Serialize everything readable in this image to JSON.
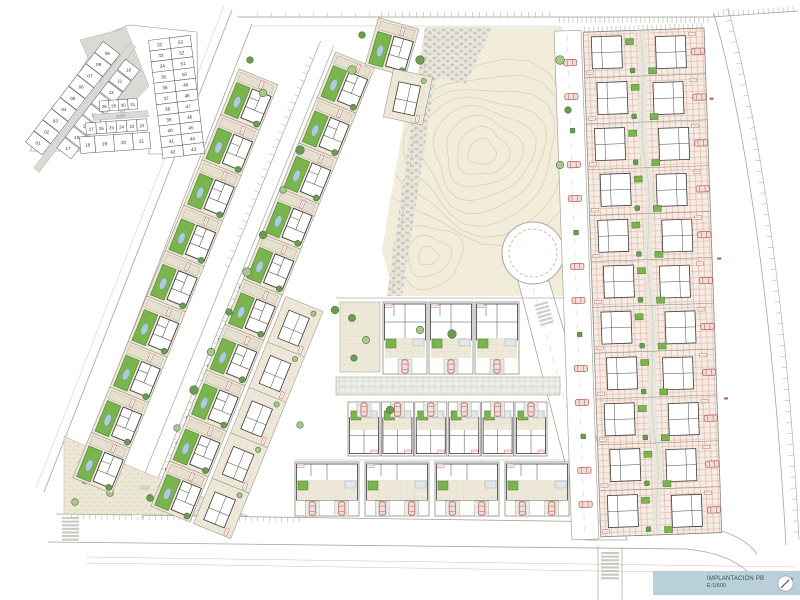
{
  "title_block": {
    "title": "IMPLANTACIÓN PB",
    "scale": "E:1/600",
    "north_label": "N"
  },
  "keyplan": {
    "zone_labels": [
      "ZC01",
      "ZC02"
    ],
    "strip_a": [
      "01",
      "02",
      "03",
      "04",
      "05",
      "06",
      "07",
      "08",
      "09"
    ],
    "strip_b": [
      "10",
      "11",
      "12",
      "13",
      "14",
      "15",
      "16",
      "17"
    ],
    "row_18_21": [
      "18",
      "19",
      "20",
      "21"
    ],
    "row_22_27": [
      "27",
      "26",
      "25",
      "24",
      "23",
      "22"
    ],
    "row_28_31": [
      "28",
      "29",
      "30",
      "31"
    ],
    "col_left": [
      "32",
      "33",
      "34",
      "35",
      "36",
      "37",
      "38",
      "39",
      "40",
      "41",
      "42"
    ],
    "col_right": [
      "53",
      "52",
      "51",
      "50",
      "49",
      "48",
      "47",
      "46",
      "45",
      "44",
      "43"
    ]
  },
  "plan_summary": {
    "villas_west_band": 9,
    "villas_east_band": 8,
    "townhouse_units": 14,
    "right_block_units": 22,
    "right_block_rows": 11,
    "right_block_cols": 2,
    "townhouse_row_counts": [
      4,
      6,
      4
    ]
  },
  "palette": {
    "paper": "#ffffff",
    "road_stroke": "#a6a49c",
    "park": "#f2ecda",
    "contour": "#d8c9a8",
    "plot_bg": "#eee8d9",
    "plot_line": "#e0d7c3",
    "lawn": "#7ab44d",
    "lawn_stroke": "#4f7c33",
    "tree": "#6b9c52",
    "tree_stroke": "#47703a",
    "tree_light": "#a9c98b",
    "pool": "#aecbd9",
    "pool_stroke": "#7b9cab",
    "hatch_bg": "#f6ece3",
    "hatch_line": "#d8ae9f",
    "gray_bg": "#edede8",
    "gray_line": "#d2d2cb",
    "cobble_bg": "#e9e6db",
    "cobble": "#cfccc1",
    "dots_bg": "#ece6d5",
    "zone_gray": "#dadad4",
    "red": "#b25a52",
    "car_fill": "#f0ddd7",
    "line_dark": "#3a3a3a",
    "title_bg": "#b9cfda",
    "title_text": "#3c4e58",
    "keyline": "#555555"
  }
}
